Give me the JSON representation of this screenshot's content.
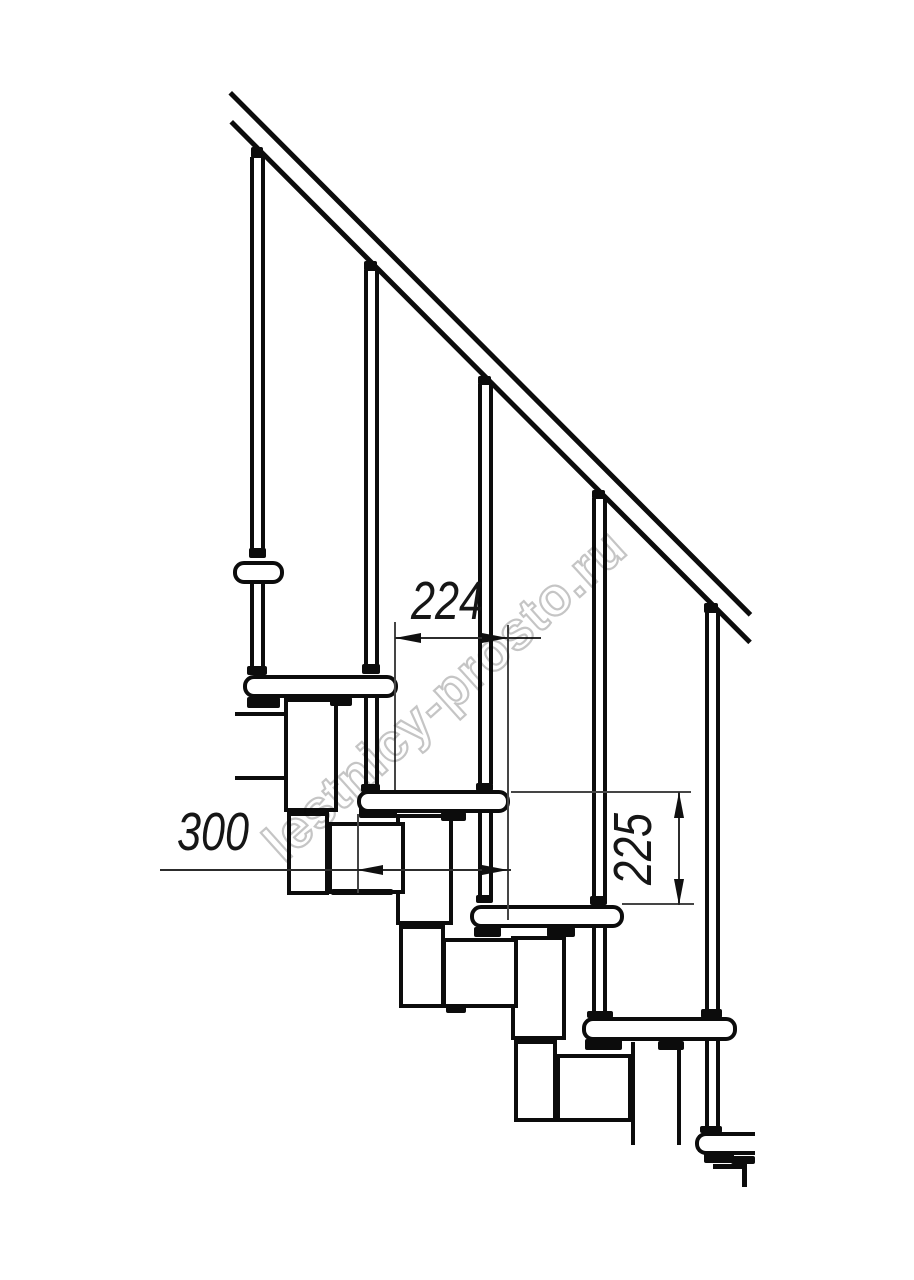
{
  "watermark": {
    "text": "lestnicy-prosto.ru"
  },
  "dimensions": {
    "step_run": "224",
    "tread_depth": "300",
    "step_rise": "225"
  }
}
